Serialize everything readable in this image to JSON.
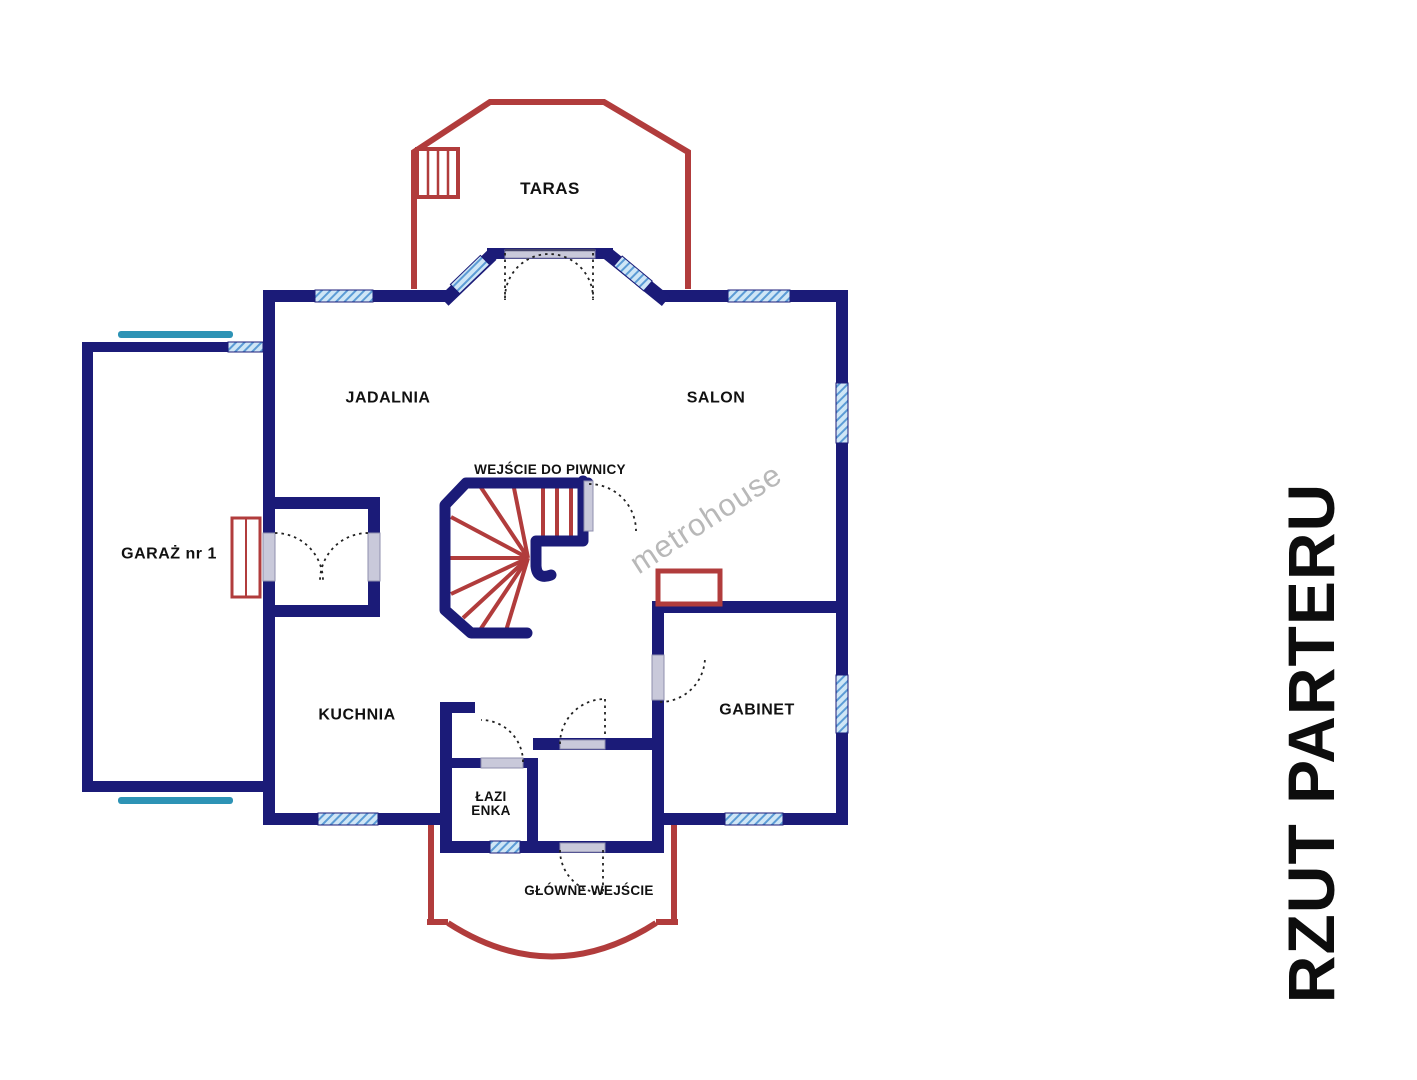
{
  "title": {
    "text": "RZUT PARTERU"
  },
  "watermark": {
    "text": "metrohouse"
  },
  "rooms": {
    "taras": "TARAS",
    "jadalnia": "JADALNIA",
    "salon": "SALON",
    "garaz": "GARAŻ nr 1",
    "kuchnia": "KUCHNIA",
    "gabinet": "GABINET",
    "lazienka_line1": "ŁAZI",
    "lazienka_line2": "ENKA"
  },
  "annotations": {
    "basement_entrance": "WEJŚCIE DO PIWNICY",
    "main_entrance": "GŁÓWNE WEJŚCIE"
  },
  "colors": {
    "wall_navy": "#1b1b78",
    "accent_red": "#b13c3c",
    "window_fill": "#cfe6f6",
    "window_stripe": "#5b9bd5",
    "teal_sill": "#2d93b5",
    "door_jamb": "#c9c9da",
    "watermark_gray": "#b8b8b8",
    "label_black": "#111111"
  }
}
